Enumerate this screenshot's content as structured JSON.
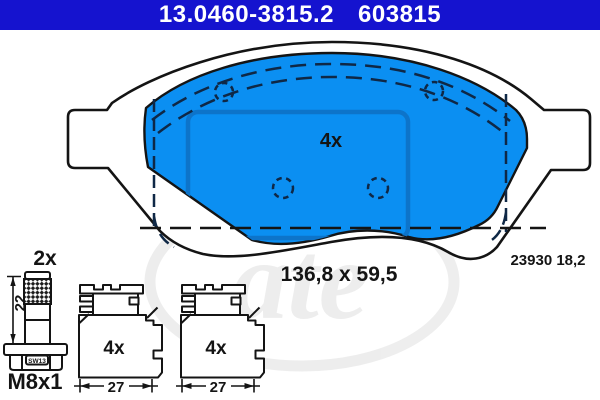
{
  "header": {
    "part_number": "13.0460-3815.2",
    "reference_number": "603815"
  },
  "colors": {
    "header_bg": "#1513cf",
    "header_text": "#ffffff",
    "pad_fill": "#0b8ff2",
    "pad_inner_border": "#0d74ca",
    "line_color": "#141414",
    "watermark_gray": "#e9e9e9"
  },
  "pad_front_view": {
    "quantity_label": "4x",
    "size_label": "136,8 x 59,5",
    "wva_label": "23930 18,2"
  },
  "guide_bolt_view": {
    "quantity_label": "2x",
    "length_label": "22",
    "wrench_size_label": "SW13",
    "thread_label": "M8x1"
  },
  "clip_profile_views": {
    "items": [
      {
        "quantity_label": "4x",
        "width_label": "27"
      },
      {
        "quantity_label": "4x",
        "width_label": "27"
      }
    ]
  },
  "watermark": {
    "text": "ate"
  }
}
